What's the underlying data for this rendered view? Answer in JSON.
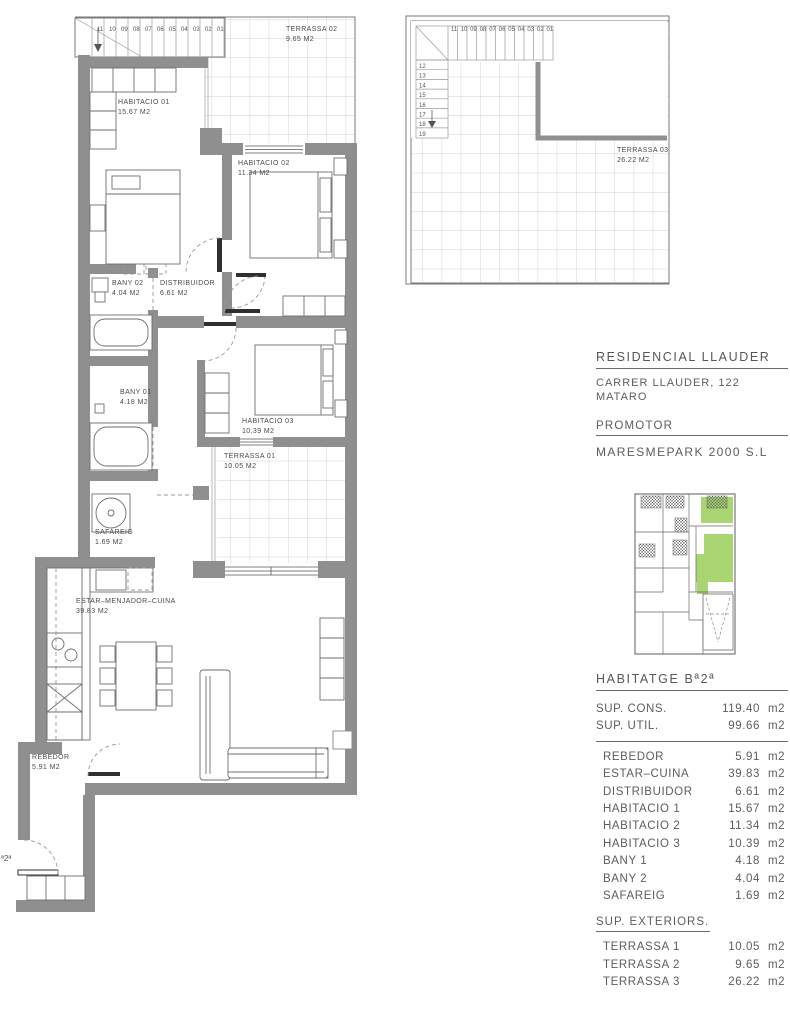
{
  "project": {
    "title": "RESIDENCIAL LLAUDER",
    "address_line1": "CARRER LLAUDER, 122",
    "address_line2": "MATARO",
    "promoter_label": "PROMOTOR",
    "promoter_name": "MARESMEPARK 2000 S.L"
  },
  "unit": {
    "heading": "HABITATGE Bª2ª",
    "unit_suffix": "m2",
    "sup_rows": [
      {
        "label": "SUP. CONS.",
        "value": "119.40",
        "unit": "m2"
      },
      {
        "label": "SUP. UTIL.",
        "value": "99.66",
        "unit": "m2"
      }
    ],
    "interior_rooms": [
      {
        "label": "REBEDOR",
        "value": "5.91",
        "unit": "m2"
      },
      {
        "label": "ESTAR–CUINA",
        "value": "39.83",
        "unit": "m2"
      },
      {
        "label": "DISTRIBUIDOR",
        "value": "6.61",
        "unit": "m2"
      },
      {
        "label": "HABITACIO 1",
        "value": "15.67",
        "unit": "m2"
      },
      {
        "label": "HABITACIO 2",
        "value": "11.34",
        "unit": "m2"
      },
      {
        "label": "HABITACIO 3",
        "value": "10.39",
        "unit": "m2"
      },
      {
        "label": "BANY 1",
        "value": "4.18",
        "unit": "m2"
      },
      {
        "label": "BANY 2",
        "value": "4.04",
        "unit": "m2"
      },
      {
        "label": "SAFAREIG",
        "value": "1.69",
        "unit": "m2"
      }
    ],
    "exteriors_heading": "SUP. EXTERIORS.",
    "exterior_rooms": [
      {
        "label": "TERRASSA 1",
        "value": "10.05",
        "unit": "m2"
      },
      {
        "label": "TERRASSA 2",
        "value": "9.65",
        "unit": "m2"
      },
      {
        "label": "TERRASSA 3",
        "value": "26.22",
        "unit": "m2"
      }
    ]
  },
  "plan": {
    "rooms": {
      "terrassa02": {
        "name": "TERRASSA 02",
        "area": "9.65 M2"
      },
      "habitacio01": {
        "name": "HABITACIO 01",
        "area": "15.67 M2"
      },
      "habitacio02": {
        "name": "HABITACIO 02",
        "area": "11.34 M2"
      },
      "bany02": {
        "name": "BANY 02",
        "area": "4.04 M2"
      },
      "distribuidor": {
        "name": "DISTRIBUIDOR",
        "area": "6.61 M2"
      },
      "bany01": {
        "name": "BANY 01",
        "area": "4.18 M2"
      },
      "habitacio03": {
        "name": "HABITACIO 03",
        "area": "10.39 M2"
      },
      "terrassa01": {
        "name": "TERRASSA 01",
        "area": "10.05 M2"
      },
      "safareig": {
        "name": "SAFAREIG",
        "area": "1.69 M2"
      },
      "estar": {
        "name": "ESTAR–MENJADOR–CUINA",
        "area": "39.83 M2"
      },
      "rebedor": {
        "name": "REBEDOR",
        "area": "5.91 M2"
      },
      "terrassa03": {
        "name": "TERRASSA 03",
        "area": "26.22 M2"
      }
    },
    "door_tag": "ª2ª",
    "stairs": {
      "main_run": [
        "11",
        "10",
        "09",
        "08",
        "07",
        "06",
        "05",
        "04",
        "03",
        "02",
        "01"
      ],
      "roof_run": [
        "11",
        "10",
        "09",
        "08",
        "07",
        "06",
        "05",
        "04",
        "03",
        "02",
        "01"
      ],
      "roof_side": [
        "12",
        "13",
        "14",
        "15",
        "16",
        "17",
        "18",
        "19"
      ]
    }
  },
  "colors": {
    "wall": "#8f8f8f",
    "key_green": "#a8d472"
  }
}
